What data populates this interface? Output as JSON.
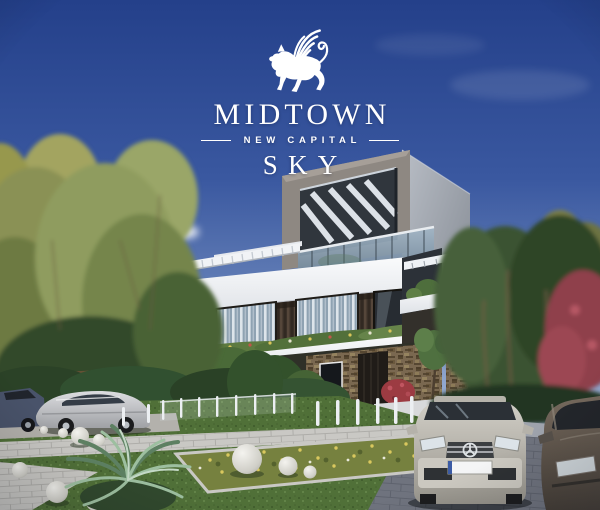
{
  "logo": {
    "emblem_icon": "winged-lion",
    "name": "MIDTOWN",
    "subtitle": "NEW CAPITAL",
    "tagline": "SKY",
    "color": "#ffffff"
  },
  "scene": {
    "type": "architectural-exterior-render",
    "description": "Modern twin villa with stacked white slabs, dark pergola roof frame, wood-slat and stone facade, balcony planters, landscaped garden with white sphere ornaments, palm plant, bollard lights, paved walkway and parked cars under a clear blue sky",
    "elements": [
      "sky",
      "clouds",
      "autumn-trees-left",
      "green-trees-right",
      "red-maple-tree",
      "villa-building",
      "pergola-roof-frame",
      "glass-balustrade",
      "louvered-canopy",
      "balcony-planters",
      "wood-slat-facade",
      "curtained-windows",
      "stone-cladding",
      "entrance-door",
      "red-flower-bush",
      "garden-hedge",
      "lawn",
      "flower-bed",
      "white-sphere-ornaments",
      "palm-plant",
      "bollard-lights",
      "glass-garden-fence",
      "paved-walkway",
      "driveway",
      "silver-sedan-front",
      "bronze-sedan-right",
      "silver-coupe-side",
      "dark-car-left-edge"
    ],
    "palette": {
      "sky_top": "#24408a",
      "sky_horizon": "#c2cde1",
      "building_white": "#f2f3f6",
      "frame_taupe": "#8e8882",
      "pergola_dark": "#30363d",
      "glass": "#8fa6ba",
      "wood_facade": "#42372c",
      "stone": "#7a6850",
      "hedge_green": "#3d5a31",
      "lawn_green": "#507038",
      "tree_olive": "#8a9154",
      "tree_dark_green": "#35512f",
      "tree_red": "#9c4752",
      "walkway": "#c9c8c4",
      "driveway": "#82868f",
      "car_silver": "#c6c3bb",
      "car_bronze": "#6a6055"
    }
  }
}
